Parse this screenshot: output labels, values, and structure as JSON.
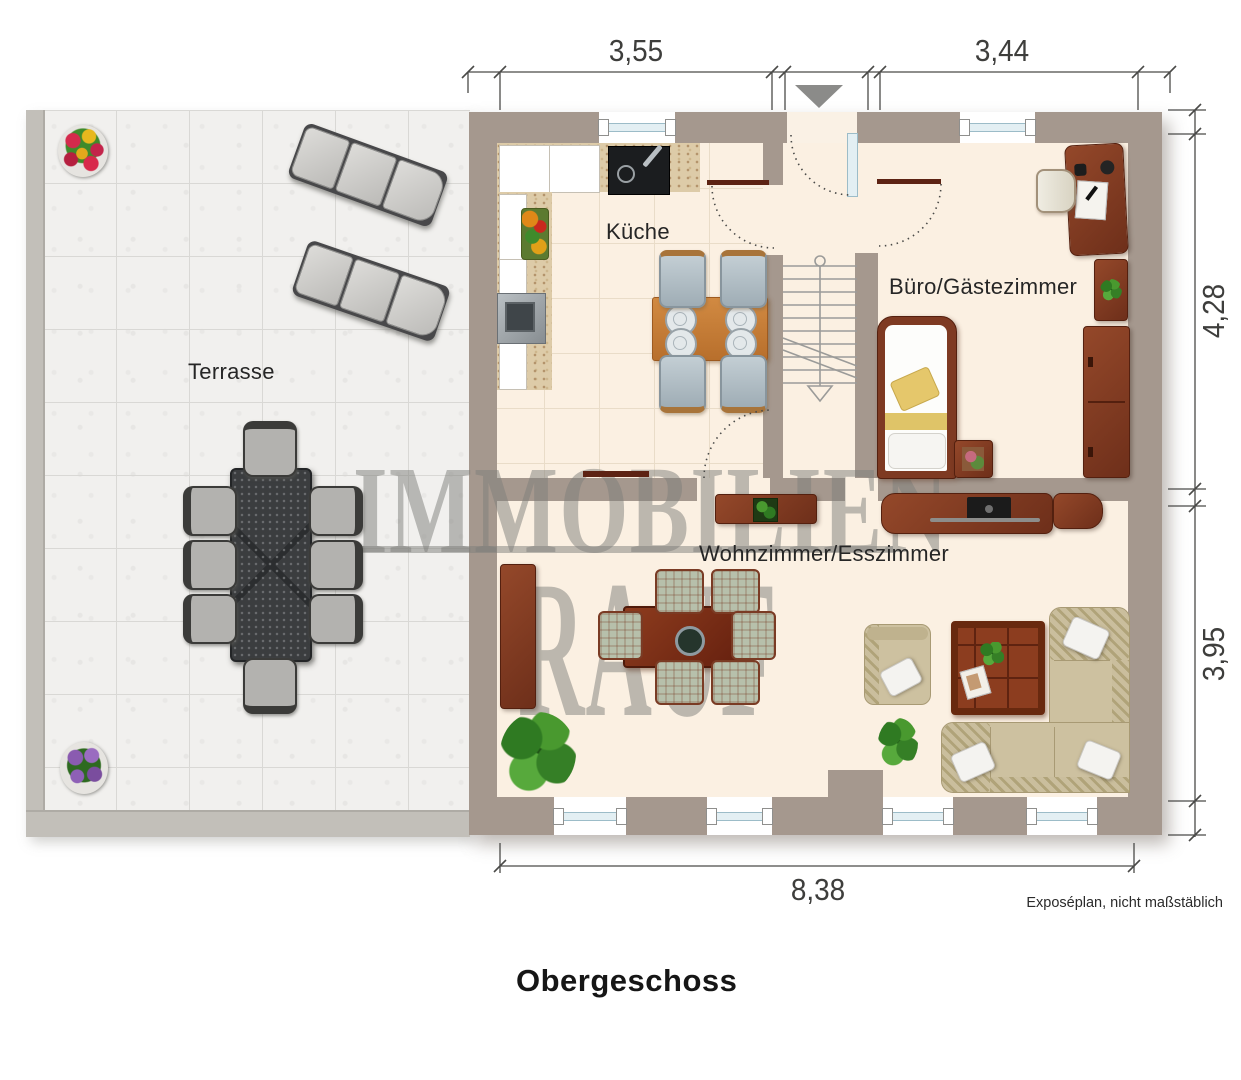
{
  "title": "Obergeschoss",
  "footnote": "Exposéplan, nicht maßstäblich",
  "watermark": {
    "line1": "IMMOBILIEN",
    "line2": "RAUF"
  },
  "rooms": {
    "terrace": "Terrasse",
    "kitchen": "Küche",
    "office": "Büro/Gästezimmer",
    "living": "Wohnzimmer/Esszimmer"
  },
  "dimensions": {
    "top_left": "3,55",
    "top_right": "3,44",
    "right_upper": "4,28",
    "right_lower": "3,95",
    "bottom": "8,38"
  },
  "colors": {
    "wall": "#a5988e",
    "floor": "#fbf0e2",
    "terrace_tile": "#f1f0ee",
    "wood_dark": "#7e3a22",
    "wood_light": "#c9823e",
    "sofa": "#cdc1a0",
    "window_glass": "#e3eff3",
    "watermark": "#7d7d7a"
  }
}
